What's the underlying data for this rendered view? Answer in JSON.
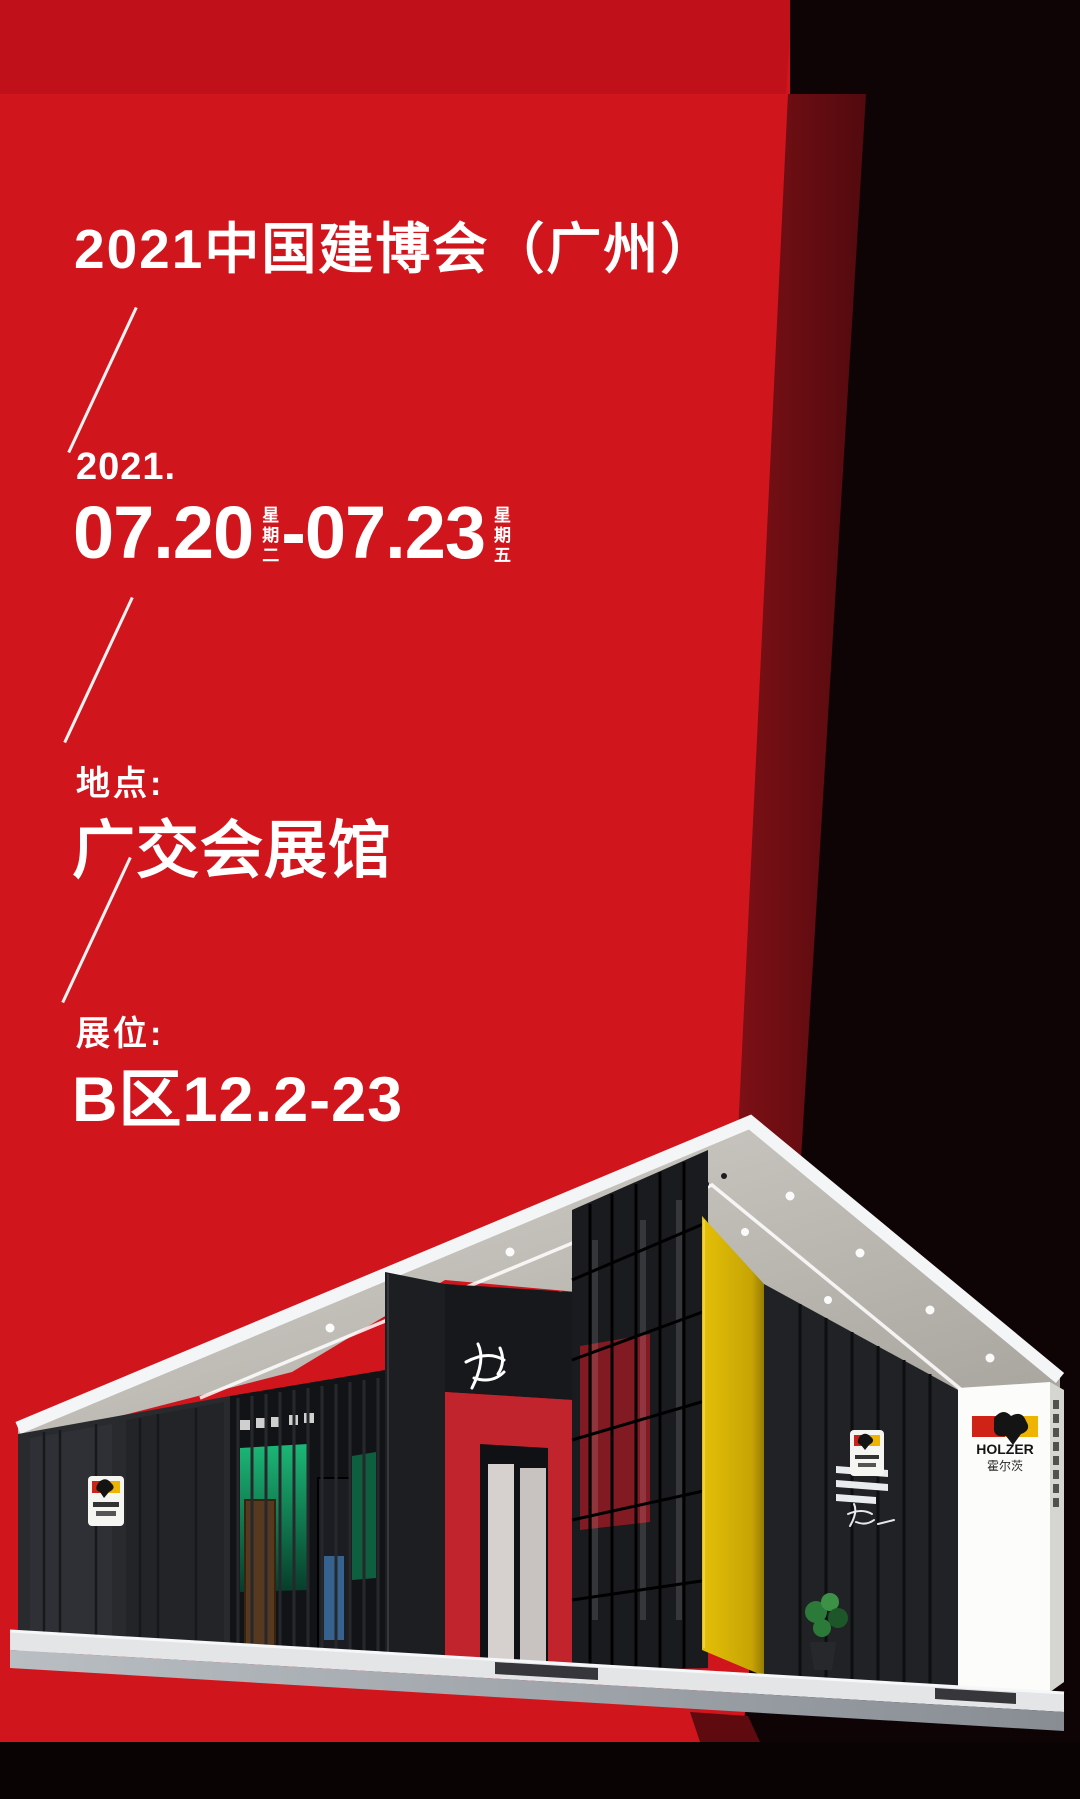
{
  "poster": {
    "title": "2021中国建博会（广州）",
    "schedule": {
      "year": "2021.",
      "start_date": "07.20",
      "start_weekday": "星期二",
      "separator": "-",
      "end_date": "07.23",
      "end_weekday": "星期五"
    },
    "venue": {
      "label": "地点:",
      "value": "广交会展馆"
    },
    "booth": {
      "label": "展位:",
      "value": "B区12.2-23"
    },
    "exhibit": {
      "brand_en": "HOLZER",
      "brand_cn": "霍尔茨"
    },
    "colors": {
      "red": "#d1151d",
      "red_top_band": "#c01019",
      "maroon": "#6f0d12",
      "black": "#0e0405",
      "accent_yellow": "#d8b406",
      "booth_red": "#c2242e",
      "display_green": "#17b273"
    },
    "icons": {
      "divider": "slash-line",
      "logo": "holzer-eagle-flag",
      "calligraphy": "brush-script-mark"
    }
  }
}
